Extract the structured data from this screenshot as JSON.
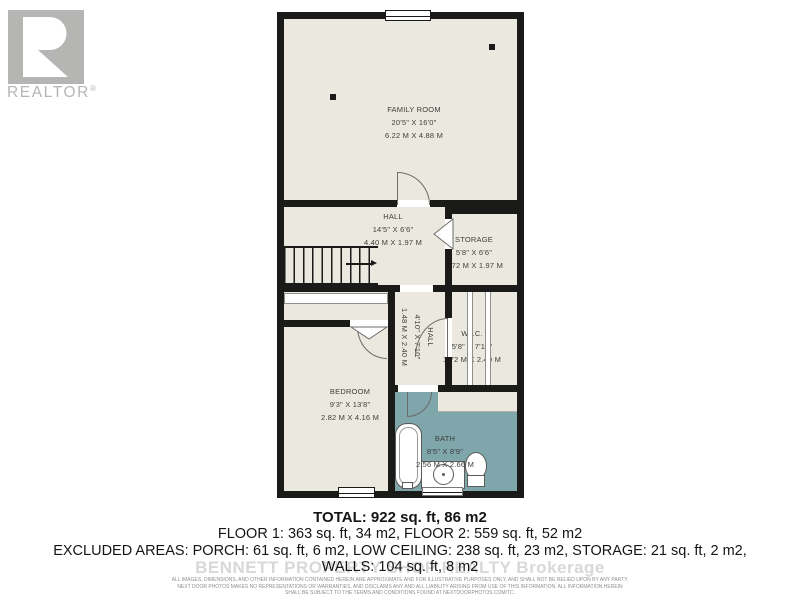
{
  "logo": {
    "brand": "REALTOR",
    "registered": "®"
  },
  "plan": {
    "rooms": {
      "family_room": {
        "name": "FAMILY ROOM",
        "imperial": "20'5\" X 16'0\"",
        "metric": "6.22 M X 4.88 M"
      },
      "hall": {
        "name": "HALL",
        "imperial": "14'5\" X 6'6\"",
        "metric": "4.40 M X 1.97 M"
      },
      "storage": {
        "name": "STORAGE",
        "imperial": "5'8\" X 6'6\"",
        "metric": "1.72 M X 1.97 M"
      },
      "lower_hall": {
        "name": "HALL",
        "imperial": "4'10\" X 7'10\"",
        "metric": "1.48 M X 2.40 M"
      },
      "wic": {
        "name": "W.I.C.",
        "imperial": "5'8\" X 7'10\"",
        "metric": "1.72 M X 2.40 M"
      },
      "bedroom": {
        "name": "BEDROOM",
        "imperial": "9'3\" X 13'8\"",
        "metric": "2.82 M X 4.16 M"
      },
      "bath": {
        "name": "BATH",
        "imperial": "8'5\" X 8'9\"",
        "metric": "2.56 M X 2.66 M"
      }
    }
  },
  "summary": {
    "total": "TOTAL: 922 sq. ft, 86 m2",
    "floors": "FLOOR 1: 363 sq. ft, 34 m2, FLOOR 2: 559 sq. ft, 52 m2",
    "excluded_areas": "EXCLUDED AREAS: PORCH: 61 sq. ft, 6 m2, LOW CEILING: 238 sq. ft, 23 m2, STORAGE: 21 sq. ft, 2 m2,",
    "walls": "WALLS: 104 sq. ft, 8 m2"
  },
  "watermark": "BENNETT PROPERTY SHOP REALTY Brokerage",
  "disclaimer": [
    "ALL IMAGES, DIMENSIONS, AND OTHER INFORMATION CONTAINED HEREIN ARE APPROXIMATE AND FOR ILLUSTRATIVE PURPOSES ONLY, AND SHALL NOT BE RELIED UPON BY ANY PARTY.",
    "NEXT DOOR PHOTOS MAKES NO REPRESENTATIONS OR WARRANTIES, AND DISCLAIMS ANY AND ALL LIABILITY ARISING FROM USE OF THIS INFORMATION. ALL INFORMATION HEREIN",
    "SHALL BE SUBJECT TO THE TERMS AND CONDITIONS FOUND AT NEXTDOORPHOTOS.COM/TC."
  ],
  "colors": {
    "wall": "#1a1a18",
    "floor": "#eae8df",
    "bath_floor": "#7fa6aa",
    "logo": "#b5b5b4"
  }
}
